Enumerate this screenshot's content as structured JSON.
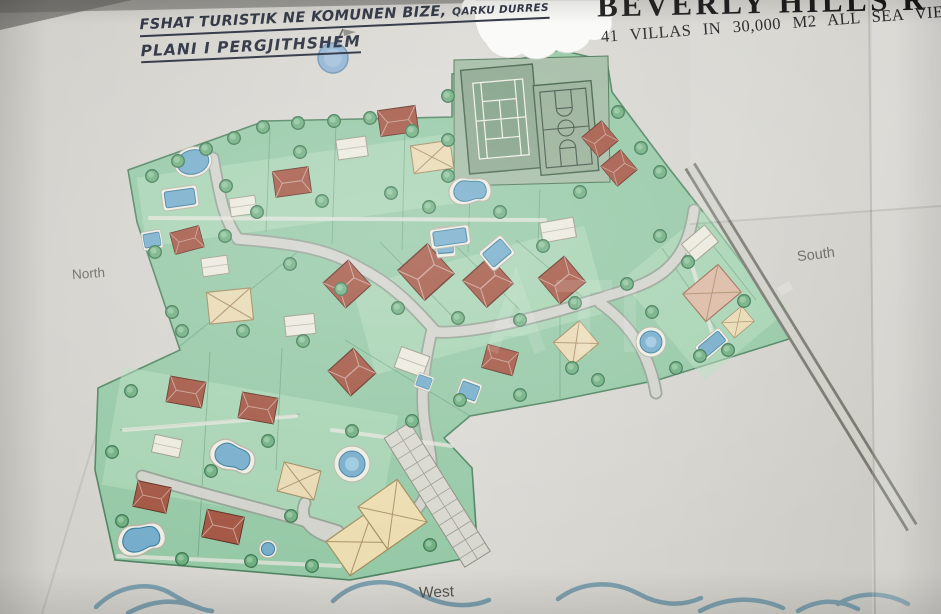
{
  "palette": {
    "paper": "#d6d4cf",
    "plan_green": "#94c8a5",
    "lawn_light": "#b7ddc0",
    "road_grey": "#d2d2cc",
    "roof_red": "#a25441",
    "roof_tan": "#e9d9b2",
    "roof_white": "#eceade",
    "pool_blue": "#74accb",
    "tree_green": "#6fae80",
    "wave_blue": "#7d9fae",
    "ink_left": "#242a3a",
    "ink_right": "#1c1c1c",
    "label_grey": "#66655f"
  },
  "header_left": {
    "line1": "FSHAT TURISTIK  NE KOMUNEN BIZE,",
    "line1_suffix": "QARKU DURRES",
    "line2": "PLANI I PERGJITHSHEM"
  },
  "header_right": {
    "title": "BEVERLY HILLS R",
    "subtitle": "41 VILLAS  IN  30,000 M2   ALL   SEA VIEW"
  },
  "compass": {
    "north": "North",
    "south": "South",
    "west": "West"
  },
  "map": {
    "features": [
      "site-boundary",
      "internal-roads",
      "perimeter-highway",
      "tennis-court",
      "basketball-court",
      "red-roof-villas",
      "cross-roof-villas",
      "white-roof-villas",
      "swimming-pools",
      "trees",
      "parking-strip",
      "clubhouse",
      "flag-marker",
      "sea-waves",
      "white-redaction-blob",
      "paper-folds"
    ]
  }
}
